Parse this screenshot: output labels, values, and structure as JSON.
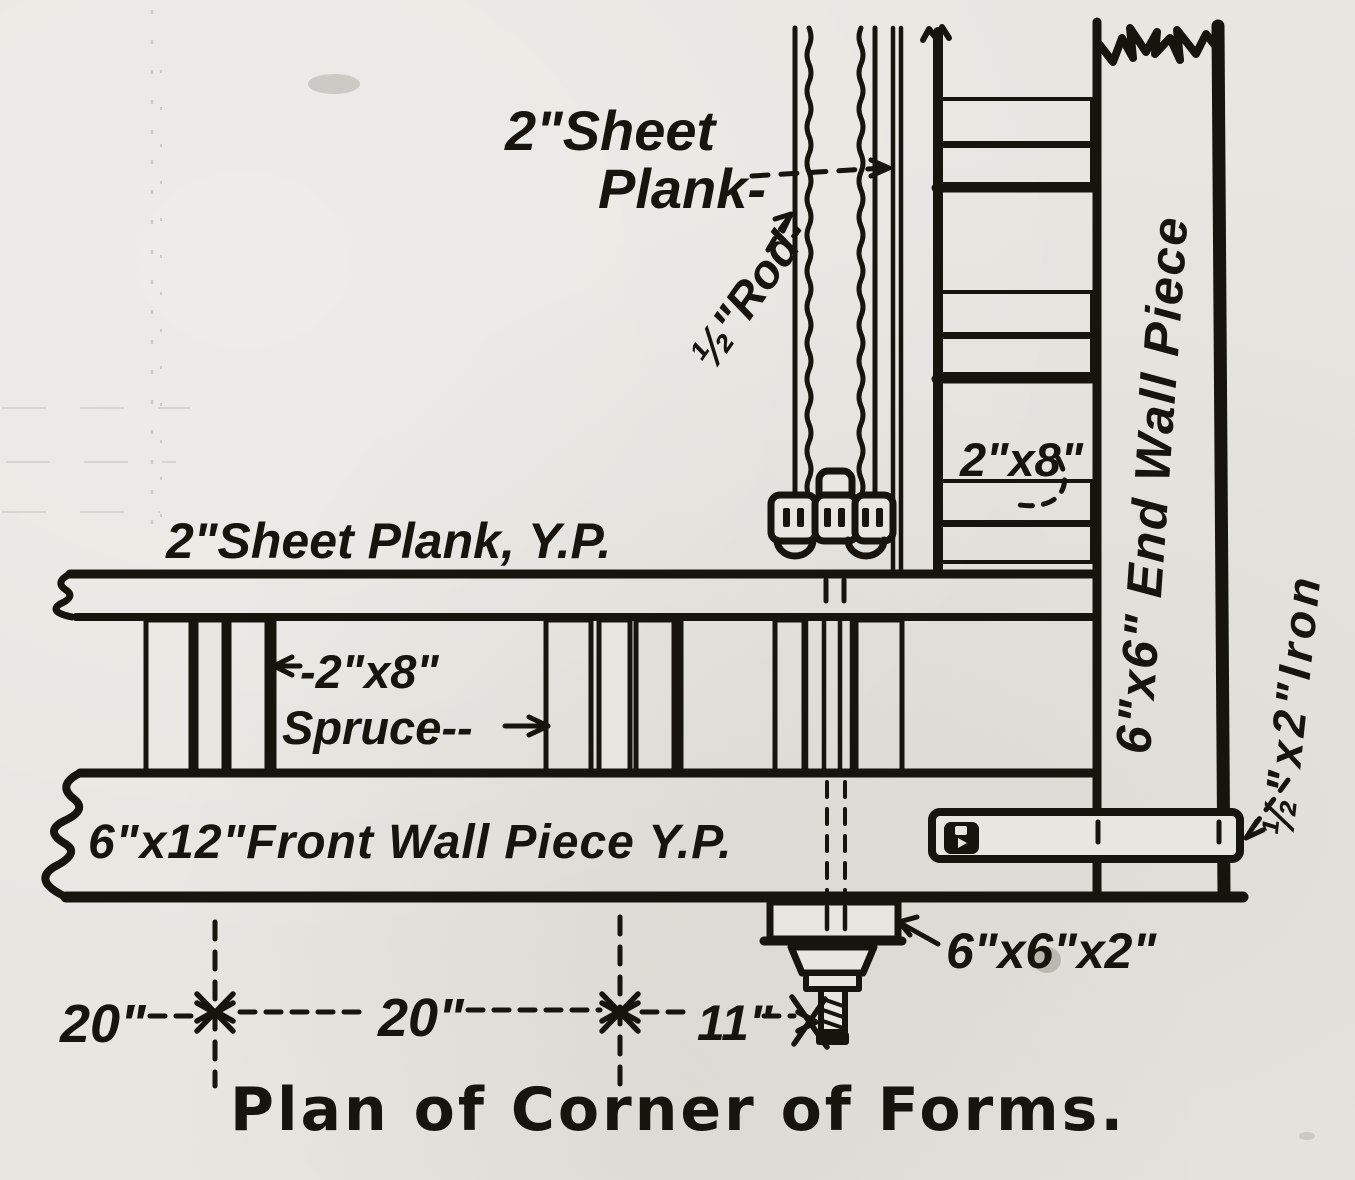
{
  "colors": {
    "ink": "#17130d",
    "paper": "#e8e6e1"
  },
  "title": "Plan of Corner of Forms.",
  "labels": {
    "sheet_plank_line1": "2\"Sheet",
    "sheet_plank_line2": "Plank-",
    "rod": "½\"Rod-",
    "plank_2x8": "2\"x8\"",
    "end_wall_piece": "6\"x6\" End Wall Piece",
    "iron_strap": "½\"x2\"Iron",
    "sheet_plank_yp": "2\"Sheet Plank, Y.P.",
    "spruce_line1": "-2\"x8\"",
    "spruce_line2": "Spruce--",
    "front_wall_piece": "6\"x12\"Front Wall Piece Y.P.",
    "corner_washer": "6\"x6\"x2\""
  },
  "dimensions": {
    "d1": "20\"",
    "d2": "20\"",
    "d3": "11\""
  }
}
